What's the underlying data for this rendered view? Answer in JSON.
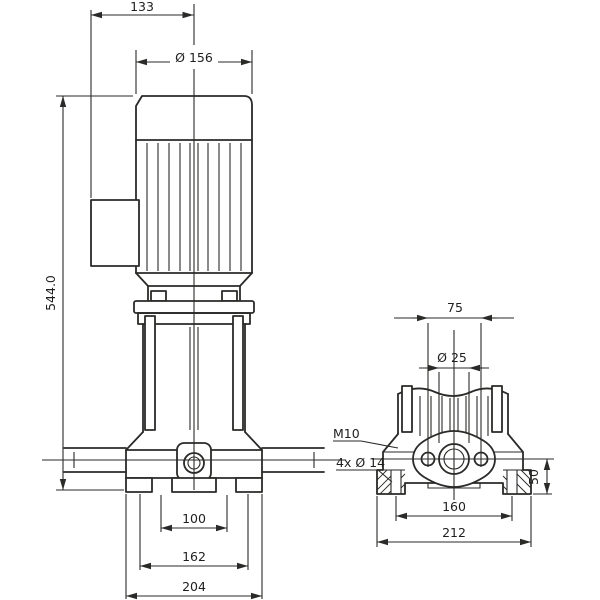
{
  "front_view": {
    "width_top": "133",
    "motor_diameter": "Ø 156",
    "height": "544.0",
    "port_span": "100",
    "bolt_span": "162",
    "base_width": "204"
  },
  "side_view": {
    "flange_bolt_spacing": "75",
    "port_diameter": "Ø 25",
    "thread": "M10",
    "mounting_holes": "4x Ø 14",
    "bolt_span": "160",
    "base_width": "212",
    "port_axis_height": "50"
  }
}
